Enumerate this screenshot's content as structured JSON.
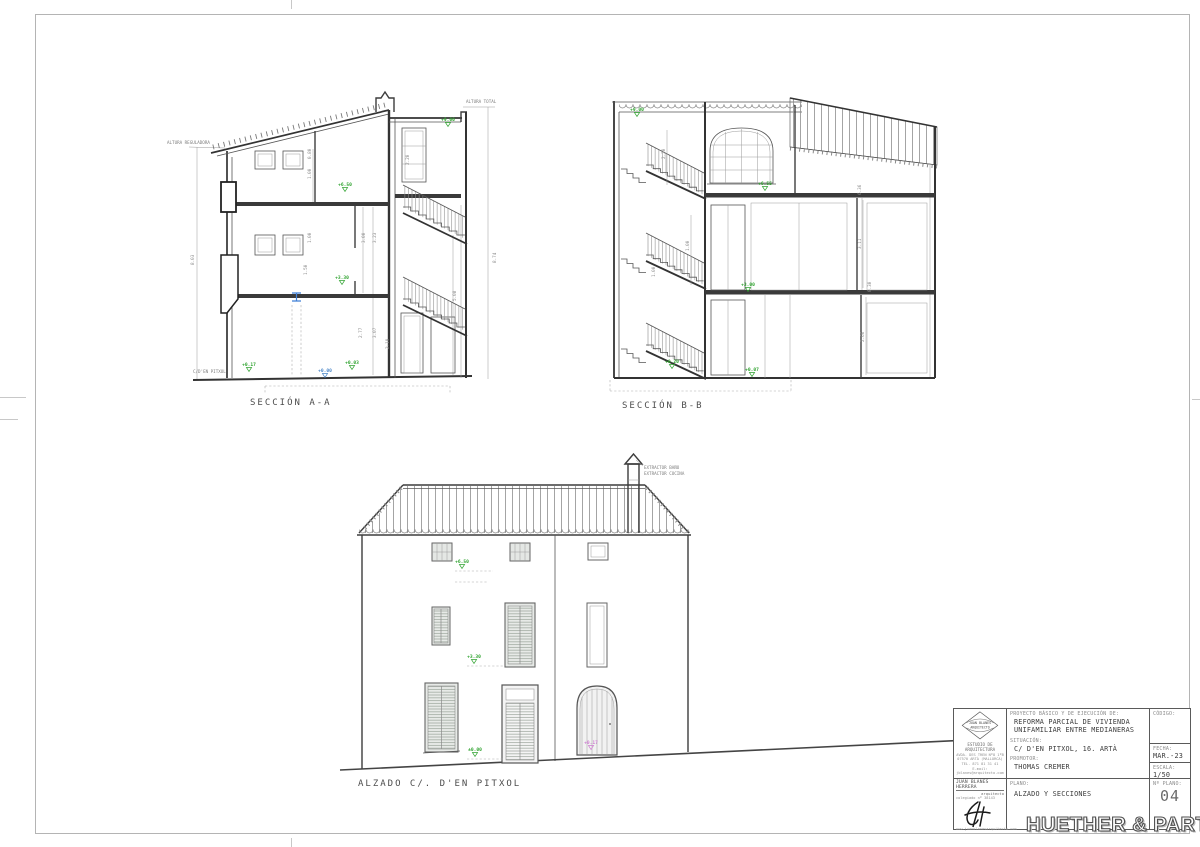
{
  "sheet": {
    "watermark": "HUETHER & PARTNER"
  },
  "section_aa": {
    "title": "SECCIÓN A-A",
    "altura_reguladora": "ALTURA REGULADORA",
    "altura_total": "ALTURA TOTAL",
    "street": "C/D'EN PITXOL",
    "total_left": "8.03",
    "total_right": "8.74",
    "dims": [
      "0.80",
      "1.00",
      "2.20",
      "1.00",
      "3.00",
      "3.23",
      "1.50",
      "2.77",
      "3.07",
      "2.19",
      "5.08"
    ],
    "levels": [
      "+9.00",
      "+6.50",
      "+3.30",
      "+0.17",
      "+0.00",
      "+0.03"
    ]
  },
  "section_bb": {
    "title": "SECCIÓN B-B",
    "dims": [
      "2.20",
      "1.00",
      "1.00",
      "6.36",
      "3.11",
      "0.30",
      "2.66"
    ],
    "levels": [
      "+9.00",
      "+6.55",
      "+3.00",
      "+0.20",
      "+0.07"
    ]
  },
  "elevation": {
    "title": "ALZADO C/. D'EN PITXOL",
    "chimney_labels": [
      "EXTRACTOR BAÑO",
      "EXTRACTOR COCINA"
    ],
    "levels": [
      "+6.50",
      "+3.30",
      "±0.00"
    ],
    "door_level": "+0.17"
  },
  "title_block": {
    "logo_name": "JUAN BLANES",
    "logo_role": "ARQUITECTO",
    "studio": "ESTUDIO DE ARQUITECTURA",
    "address": [
      "AVDA. DES TREN Nº8 1ºB",
      "07570 ARTÀ (MALLORCA)",
      "TEL. 871 81 31 41",
      "E-mail: jblanes@arquitecto.com"
    ],
    "firm_name": "JUAN BLANES HERRERA",
    "firm_role": "arquitecto",
    "firm_colegiado": "colegiado nº 38143",
    "website": "www.juanblanesarquitecto.com",
    "project_label": "PROYECTO BÁSICO Y DE EJECUCIÓN DE:",
    "project": "REFORMA PARCIAL DE VIVIENDA UNIFAMILIAR ENTRE MEDIANERAS",
    "situacion_label": "SITUACIÓN:",
    "situacion": "C/ D'EN PITXOL, 16. ARTÀ",
    "promotor_label": "PROMOTOR:",
    "promotor": "THOMAS CREMER",
    "codigo_label": "CÓDIGO:",
    "fecha_label": "FECHA:",
    "fecha": "MAR.-23",
    "escala_label": "ESCALA:",
    "escala": "1/50",
    "plano_label": "PLANO:",
    "plano": "ALZADO Y SECCIONES",
    "num_label": "Nº PLANO:",
    "num": "04"
  }
}
